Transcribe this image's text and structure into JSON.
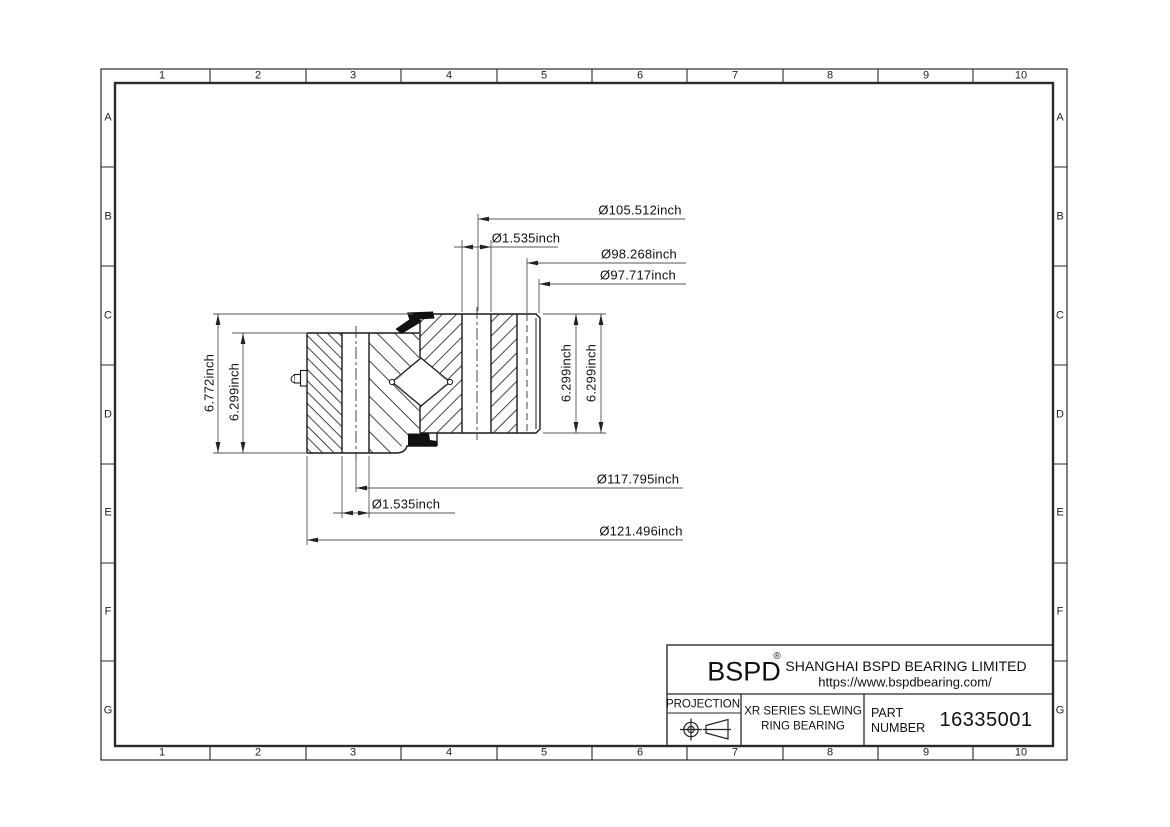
{
  "frame": {
    "columns": [
      "1",
      "2",
      "3",
      "4",
      "5",
      "6",
      "7",
      "8",
      "9",
      "10"
    ],
    "rows": [
      "A",
      "B",
      "C",
      "D",
      "E",
      "F",
      "G"
    ]
  },
  "dimensions": {
    "d105": "Ø105.512inch",
    "d1535_top": "Ø1.535inch",
    "d98": "Ø98.268inch",
    "d97": "Ø97.717inch",
    "right_height_1": "6.299inch",
    "right_height_2": "6.299inch",
    "left_total_height": "6.772inch",
    "left_inner_height": "6.299inch",
    "d117": "Ø117.795inch",
    "d1535_bottom": "Ø1.535inch",
    "d121": "Ø121.496inch"
  },
  "title_block": {
    "brand": "BSPD",
    "registered": "®",
    "company": "SHANGHAI BSPD BEARING LIMITED",
    "website": "https://www.bspdbearing.com/",
    "projection_label": "PROJECTION",
    "product_line1": "XR SERIES SLEWING",
    "product_line2": "RING BEARING",
    "part_label_line1": "PART",
    "part_label_line2": "NUMBER",
    "part_number": "16335001"
  },
  "colors": {
    "line": "#1a1a1a",
    "thin_line": "#555555",
    "seal_fill": "#111111",
    "background": "#ffffff"
  }
}
